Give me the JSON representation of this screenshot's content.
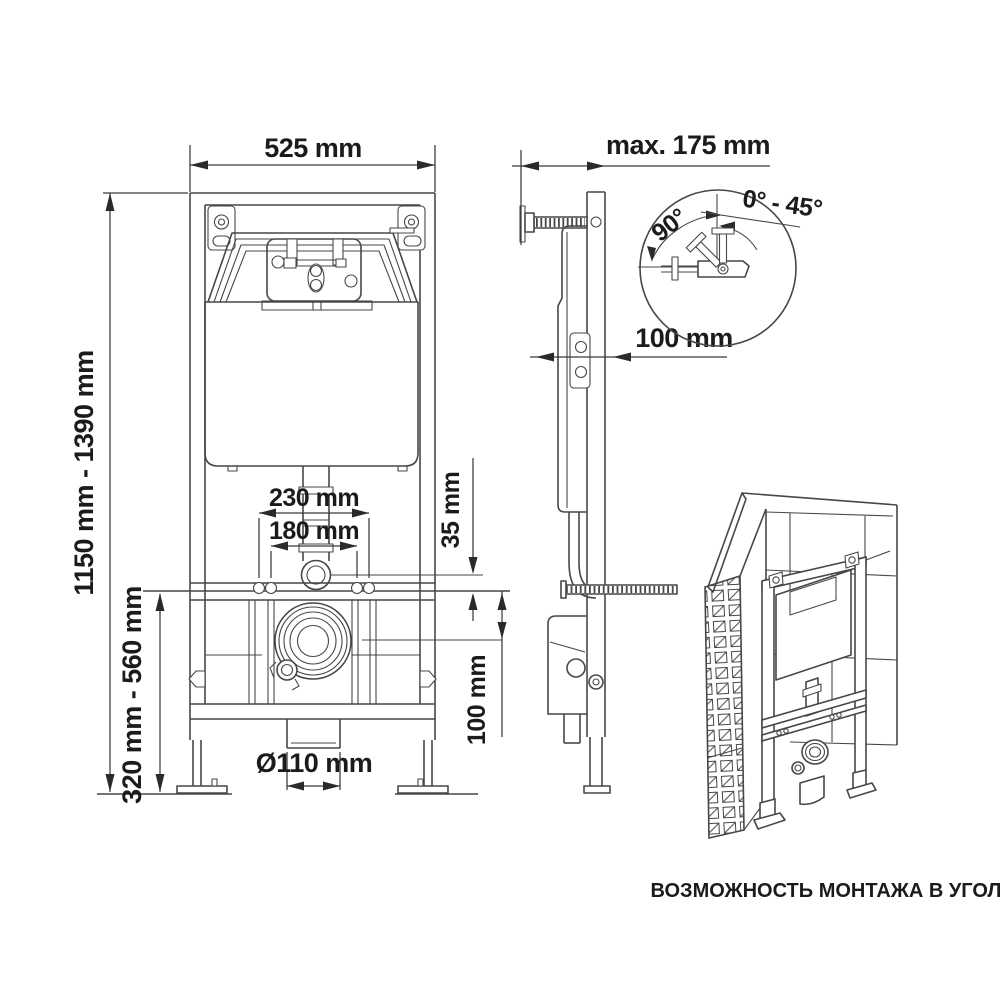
{
  "drawing": {
    "front_view": {
      "width": "525 mm",
      "height_range": "1150 mm - 1390 mm",
      "lower_height_range": "320 mm - 560 mm",
      "fixing_outer": "230 mm",
      "fixing_inner": "180 mm",
      "inlet_offset": "35 mm",
      "outlet_offset": "100 mm",
      "outlet_diameter": "Ø110 mm"
    },
    "side_view": {
      "max_depth": "max. 175 mm",
      "depth": "100 mm"
    },
    "detail_view": {
      "angle_main": "90°",
      "angle_range": "0° - 45°"
    },
    "isometric_view": {
      "caption": "ВОЗМОЖНОСТЬ МОНТАЖА В УГОЛ"
    }
  }
}
